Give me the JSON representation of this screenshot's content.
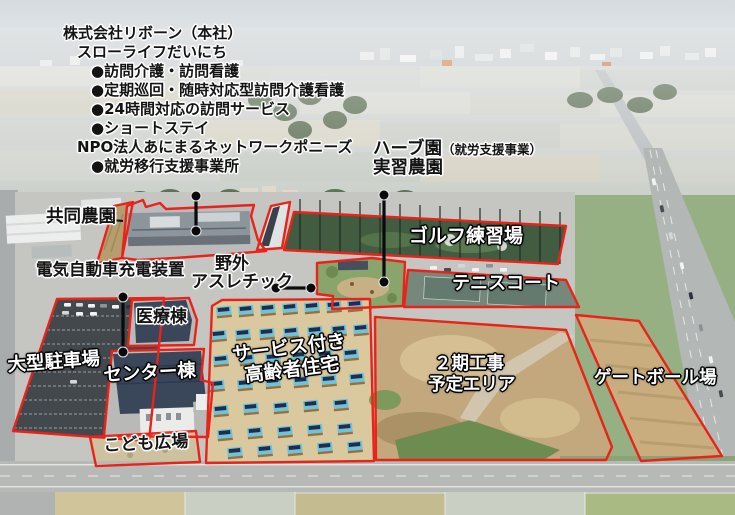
{
  "colors": {
    "outline_red": "#e8241a",
    "pointer_black": "#000000",
    "label_dark": "#141414",
    "label_white": "#ffffff"
  },
  "info_block": {
    "company": "株式会社リボーン（本社）",
    "facility": "スローライフだいにち",
    "services": [
      "●訪問介護・訪問看護",
      "●定期巡回・随時対応型訪問介護看護",
      "●24時間対応の訪問サービス",
      "●ショートステイ"
    ],
    "npo": "NPO法人あにまるネットワークポニーズ",
    "npo_services": [
      "●就労移行支援事業所"
    ]
  },
  "zone_labels": {
    "herb_garden": {
      "title": "ハーブ園",
      "note": "（就労支援事業）",
      "subtitle": "実習農園"
    },
    "communal_farm": "共同農園",
    "golf_range": "ゴルフ練習場",
    "ev_charging": "電気自動車充電装置",
    "outdoor_athletic": {
      "line1": "野外",
      "line2": "アスレチック"
    },
    "tennis_court": "テニスコート",
    "medical_building": "医療棟",
    "large_parking": "大型駐車場",
    "center_building": "センター棟",
    "senior_housing": {
      "line1": "サービス付き",
      "line2": "高齢者住宅"
    },
    "phase2_area": {
      "line1": "２期工事",
      "line2": "予定エリア"
    },
    "gateball_field": "ゲートボール場",
    "kids_plaza": "こども広場"
  }
}
